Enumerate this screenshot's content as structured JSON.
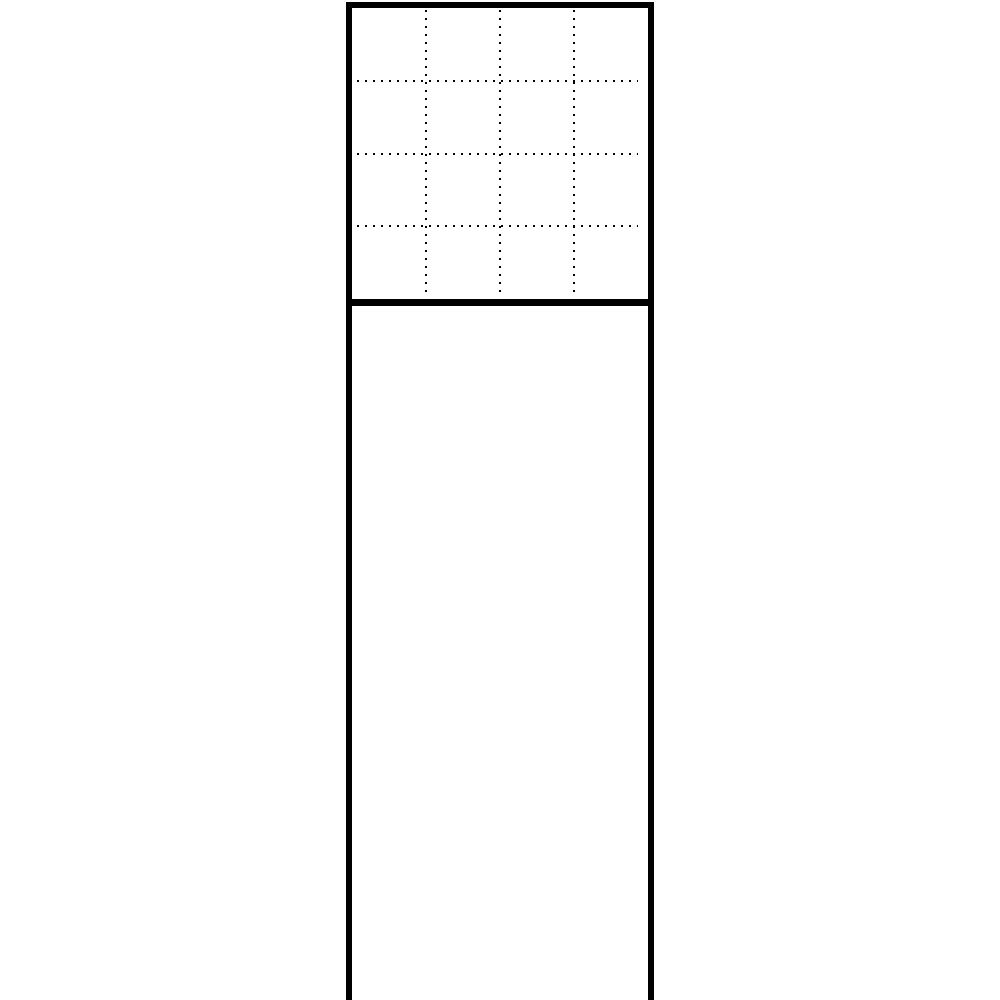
{
  "figure": {
    "type": "line-drawing",
    "background_color": "#ffffff",
    "stroke_color": "#000000",
    "panel": {
      "outline_style": "solid",
      "bottom_edge_visible": false,
      "grid_section": {
        "rows": 4,
        "cols": 4,
        "grid_line_style": "dotted"
      },
      "lower_section": {
        "content": "empty"
      }
    }
  }
}
